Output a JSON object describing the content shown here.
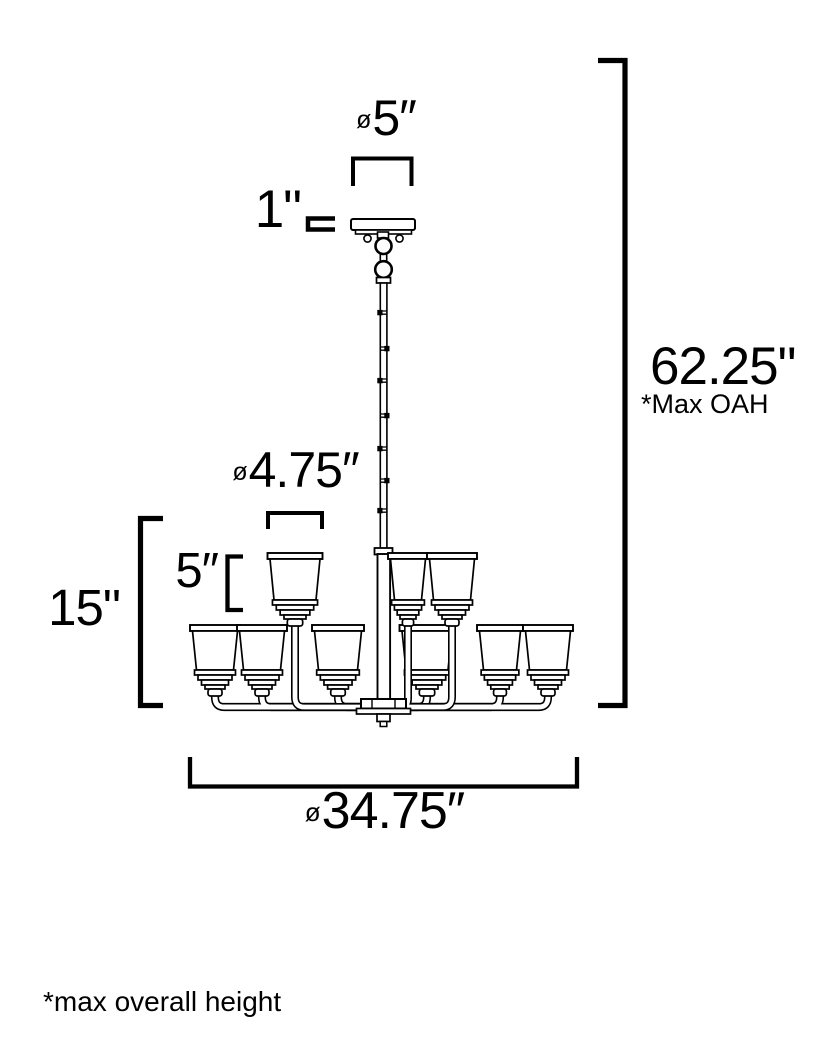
{
  "diagram": {
    "title": "chandelier dimension drawing",
    "dimensions": {
      "canopy_diameter": {
        "prefix": "ø",
        "value": "5″"
      },
      "canopy_height": {
        "value": "1\""
      },
      "max_overall_height": {
        "value": "62.25\""
      },
      "max_overall_height_note": "*Max OAH",
      "shade_diameter": {
        "prefix": "ø",
        "value": "4.75″"
      },
      "shade_height": {
        "value": "5″"
      },
      "fixture_height": {
        "value": "15\""
      },
      "fixture_diameter": {
        "prefix": "ø",
        "value": "34.75″"
      }
    },
    "footnote": "*max overall height",
    "fixture": {
      "lights_lower_tier": 6,
      "lights_upper_tier": 3
    },
    "colors": {
      "line": "#000000",
      "background": "#ffffff"
    }
  }
}
